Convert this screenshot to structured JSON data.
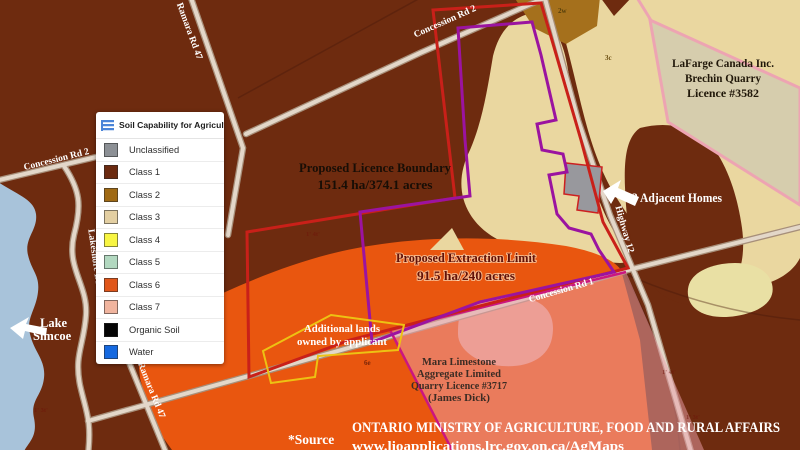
{
  "legend": {
    "title": "Soil Capability for Agriculture",
    "items": [
      {
        "label": "Unclassified",
        "color": "#8c9095"
      },
      {
        "label": "Class 1",
        "color": "#6b2a10"
      },
      {
        "label": "Class 2",
        "color": "#a06a14"
      },
      {
        "label": "Class 3",
        "color": "#e3cfa2"
      },
      {
        "label": "Class 4",
        "color": "#f8f542"
      },
      {
        "label": "Class 5",
        "color": "#b2d8c0"
      },
      {
        "label": "Class 6",
        "color": "#e0561a"
      },
      {
        "label": "Class 7",
        "color": "#f0b49e"
      },
      {
        "label": "Organic Soil",
        "color": "#050505"
      },
      {
        "label": "Water",
        "color": "#1569e0"
      }
    ]
  },
  "labels": {
    "licence": {
      "line1": "Proposed Licence Boundary",
      "line2": "151.4 ha/374.1 acres"
    },
    "extraction": {
      "line1": "Proposed Extraction Limit",
      "line2": "91.5 ha/240 acres"
    },
    "homes": "3 Adjacent Homes",
    "lafarge": {
      "line1": "LaFarge Canada Inc.",
      "line2": "Brechin Quarry",
      "line3": "Licence #3582"
    },
    "mara": {
      "line1": "Mara Limestone",
      "line2": "Aggregate Limited",
      "line3": "Quarry Licence #3717",
      "line4": "(James Dick)"
    },
    "additional": {
      "line1": "Additional lands",
      "line2": "owned by applicant"
    },
    "lake": {
      "line1": "Lake",
      "line2": "Simcoe"
    }
  },
  "roads": {
    "concession_rd_2_top": "Concession Rd 2",
    "concession_rd_2_left": "Concession Rd 2",
    "ramara_rd_47_top": "Ramara Rd 47",
    "ramara_rd_47_bottom": "Ramara Rd 47",
    "lakeshore_drive": "Lakeshore Drive",
    "highway_12": "Highway 12",
    "concession_rd_1": "Concession Rd 1"
  },
  "source": {
    "prefix": "*Source",
    "ministry": "ONTARIO MINISTRY OF AGRICULTURE, FOOD AND RURAL AFFAIRS",
    "url": "www.lioapplications.lrc.gov.on.ca/AgMaps"
  },
  "parcel_codes": {
    "c2w": "2w",
    "c3c": "3c",
    "c6e": "6e"
  },
  "lot_marks": {
    "m1": "1' 4t'",
    "m2": "1' 3t'",
    "m3": "1' 4t'",
    "m4": "1' 3t'"
  },
  "colors": {
    "class1": "#6e2b0f",
    "class2": "#a5701c",
    "class3": "#ead7a0",
    "class3_pale": "#e9e0a4",
    "class6": "#e9560f",
    "class7": "#ee9d80",
    "unclassified": "#98989d",
    "lake": "#a8c3da",
    "road_fill": "#e3d7c9",
    "road_casing": "#a78f7a",
    "red_boundary": "#c92019",
    "purple_boundary": "#9b13a0",
    "magenta_edge": "#cb1680",
    "yellow_outline": "#edc213",
    "pink_lafarge": "#eda4b2",
    "lafarge_fill": "#d6cdad",
    "overlay_pink": "rgba(236,160,170,0.5)"
  }
}
